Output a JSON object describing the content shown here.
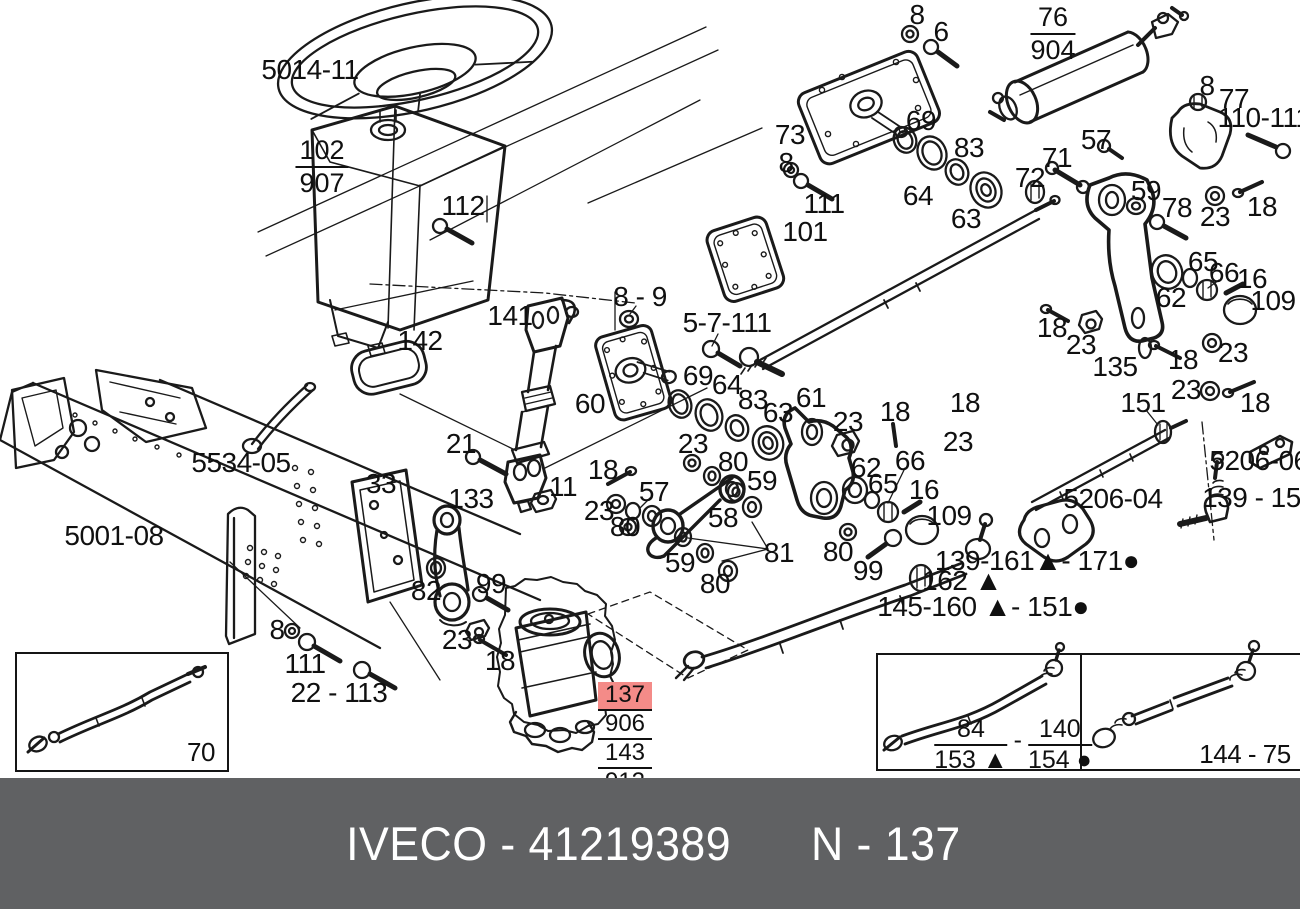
{
  "banner": {
    "left": "IVECO - 41219389",
    "right": "N - 137",
    "bg": "#606163",
    "fg": "#ffffff"
  },
  "highlight_color": "#f48b88",
  "labels": [
    {
      "t": "5014-11",
      "x": 310,
      "y": 70
    },
    {
      "t": "112",
      "x": 463,
      "y": 206
    },
    {
      "t": "142",
      "x": 420,
      "y": 341
    },
    {
      "t": "141",
      "x": 510,
      "y": 316
    },
    {
      "t": "8 - 9",
      "x": 640,
      "y": 297
    },
    {
      "t": "5-7-111",
      "x": 727,
      "y": 323
    },
    {
      "t": "60",
      "x": 590,
      "y": 404
    },
    {
      "t": "69",
      "x": 698,
      "y": 376
    },
    {
      "t": "64",
      "x": 727,
      "y": 385
    },
    {
      "t": "83",
      "x": 753,
      "y": 400
    },
    {
      "t": "63",
      "x": 778,
      "y": 413
    },
    {
      "t": "61",
      "x": 811,
      "y": 398
    },
    {
      "t": "23",
      "x": 848,
      "y": 422
    },
    {
      "t": "18",
      "x": 895,
      "y": 412
    },
    {
      "t": "23",
      "x": 693,
      "y": 444
    },
    {
      "t": "80",
      "x": 733,
      "y": 462
    },
    {
      "t": "59",
      "x": 762,
      "y": 481
    },
    {
      "t": "57",
      "x": 654,
      "y": 492
    },
    {
      "t": "18",
      "x": 603,
      "y": 470
    },
    {
      "t": "23",
      "x": 599,
      "y": 511
    },
    {
      "t": "80",
      "x": 625,
      "y": 527
    },
    {
      "t": "58",
      "x": 723,
      "y": 518
    },
    {
      "t": "59",
      "x": 680,
      "y": 563
    },
    {
      "t": "80",
      "x": 715,
      "y": 584
    },
    {
      "t": "81",
      "x": 779,
      "y": 553
    },
    {
      "t": "80",
      "x": 838,
      "y": 552
    },
    {
      "t": "99",
      "x": 868,
      "y": 571
    },
    {
      "t": "62",
      "x": 866,
      "y": 468
    },
    {
      "t": "65",
      "x": 883,
      "y": 484
    },
    {
      "t": "66",
      "x": 910,
      "y": 461
    },
    {
      "t": "16",
      "x": 924,
      "y": 490
    },
    {
      "t": "109",
      "x": 949,
      "y": 516
    },
    {
      "t": "18",
      "x": 965,
      "y": 403
    },
    {
      "t": "23",
      "x": 958,
      "y": 442
    },
    {
      "t": "162 ▲",
      "x": 962,
      "y": 581
    },
    {
      "t": "145-160 ▲- 151●",
      "x": 983,
      "y": 607
    },
    {
      "t": "139-161▲- 171●",
      "x": 1037,
      "y": 561
    },
    {
      "t": "21",
      "x": 461,
      "y": 444
    },
    {
      "t": "11",
      "x": 563,
      "y": 487
    },
    {
      "t": "33",
      "x": 381,
      "y": 484
    },
    {
      "t": "133",
      "x": 471,
      "y": 499
    },
    {
      "t": "5534-05",
      "x": 241,
      "y": 463
    },
    {
      "t": "5001-08",
      "x": 114,
      "y": 536
    },
    {
      "t": "82",
      "x": 426,
      "y": 591
    },
    {
      "t": "99",
      "x": 491,
      "y": 584
    },
    {
      "t": "8",
      "x": 277,
      "y": 630
    },
    {
      "t": "111",
      "x": 305,
      "y": 664
    },
    {
      "t": "23",
      "x": 457,
      "y": 640
    },
    {
      "t": "18",
      "x": 500,
      "y": 661
    },
    {
      "t": "22 - 113",
      "x": 339,
      "y": 693
    },
    {
      "t": "70",
      "x": 201,
      "y": 752,
      "s": 26
    },
    {
      "t": "8",
      "x": 917,
      "y": 15
    },
    {
      "t": "6",
      "x": 941,
      "y": 32
    },
    {
      "t": "73",
      "x": 790,
      "y": 135
    },
    {
      "t": "8",
      "x": 786,
      "y": 163
    },
    {
      "t": "111",
      "x": 824,
      "y": 204
    },
    {
      "t": "101",
      "x": 805,
      "y": 232
    },
    {
      "t": "69",
      "x": 921,
      "y": 121
    },
    {
      "t": "64",
      "x": 918,
      "y": 196
    },
    {
      "t": "83",
      "x": 969,
      "y": 148
    },
    {
      "t": "63",
      "x": 966,
      "y": 219
    },
    {
      "t": "71",
      "x": 1057,
      "y": 158
    },
    {
      "t": "72",
      "x": 1030,
      "y": 178
    },
    {
      "t": "57",
      "x": 1096,
      "y": 140
    },
    {
      "t": "8",
      "x": 1207,
      "y": 86
    },
    {
      "t": "77",
      "x": 1234,
      "y": 99
    },
    {
      "t": "110-111",
      "x": 1264,
      "y": 118
    },
    {
      "t": "59",
      "x": 1146,
      "y": 191
    },
    {
      "t": "78",
      "x": 1177,
      "y": 208
    },
    {
      "t": "23",
      "x": 1215,
      "y": 217
    },
    {
      "t": "18",
      "x": 1262,
      "y": 207
    },
    {
      "t": "65",
      "x": 1203,
      "y": 262
    },
    {
      "t": "66",
      "x": 1224,
      "y": 273
    },
    {
      "t": "16",
      "x": 1252,
      "y": 279
    },
    {
      "t": "62",
      "x": 1171,
      "y": 298
    },
    {
      "t": "109",
      "x": 1273,
      "y": 301
    },
    {
      "t": "18",
      "x": 1052,
      "y": 328
    },
    {
      "t": "23",
      "x": 1081,
      "y": 345
    },
    {
      "t": "135",
      "x": 1115,
      "y": 367
    },
    {
      "t": "18",
      "x": 1183,
      "y": 360
    },
    {
      "t": "23",
      "x": 1233,
      "y": 353
    },
    {
      "t": "23",
      "x": 1186,
      "y": 390
    },
    {
      "t": "18",
      "x": 1255,
      "y": 403
    },
    {
      "t": "151",
      "x": 1143,
      "y": 403
    },
    {
      "t": "5206-06",
      "x": 1259,
      "y": 461
    },
    {
      "t": "5206-04",
      "x": 1113,
      "y": 499
    },
    {
      "t": "139 - 152",
      "x": 1259,
      "y": 498
    },
    {
      "t": "144 - 75",
      "x": 1245,
      "y": 754,
      "s": 26
    }
  ],
  "fractions": [
    {
      "num": "102",
      "den": "907",
      "x": 322,
      "y": 136
    },
    {
      "num": "76",
      "den": "904",
      "x": 1053,
      "y": 3
    }
  ],
  "part_stack": {
    "x": 625,
    "y": 682,
    "rows": [
      "137",
      "906",
      "143",
      "912"
    ],
    "highlighted_row": 0
  },
  "inset_fraction": {
    "x": 1013,
    "y": 716,
    "left": {
      "num": "84",
      "den": "153 ▲"
    },
    "separator": "-",
    "right": {
      "num": "140",
      "den": "154 ●"
    }
  }
}
